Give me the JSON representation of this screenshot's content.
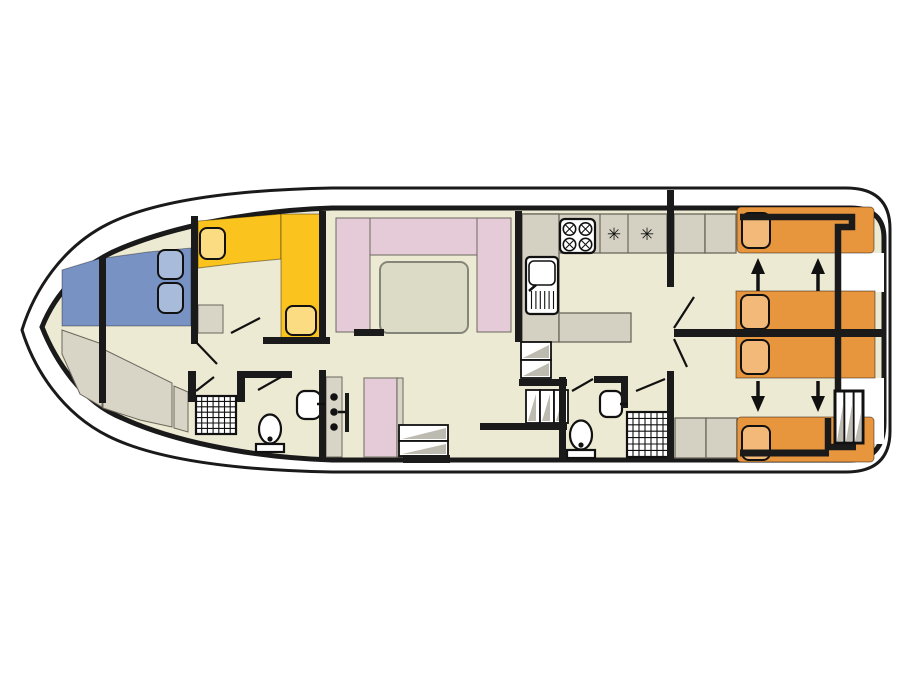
{
  "plan": {
    "type": "boat-floorplan",
    "orientation": "bow-left",
    "areas": [
      "bow-cabin",
      "forward-bathroom",
      "port-cabin",
      "saloon",
      "galley",
      "mid-cabin",
      "aft-stairs",
      "aft-bathroom",
      "aft-cabin-port",
      "aft-cabin-starboard",
      "stern-deck"
    ],
    "berths": {
      "bow_double": 1,
      "port_l_shaped_singles": 2,
      "mid_single": 1,
      "aft_fixed_singles": 2,
      "aft_sliding_doubles": 2
    },
    "fixtures": {
      "toilets": 2,
      "showers": 2,
      "washbasins": 2,
      "hob_burners": 4,
      "galley_sink": 1,
      "appliance_symbols": 2,
      "stern_ladder": 1,
      "step_flights": 3
    },
    "sliding_bed_arrows": {
      "up": 2,
      "down": 2
    }
  },
  "symbols": {
    "appliance_star": "✳"
  },
  "colors": {
    "hull": "#FFFFFF",
    "line": "#1A1A1A",
    "floor": "#EDEAD3",
    "bench": "#D8D5C6",
    "counter": "#D5D1C2",
    "edge": "#6B675C",
    "blue": "#7792C3",
    "blue_l": "#A9BBDA",
    "yellow": "#FBC31D",
    "yellow_l": "#FCDC82",
    "pink": "#E5CBD8",
    "table": "#DCDBC5",
    "table_edge": "#85857A",
    "orange": "#E8963E",
    "orange_l": "#F2B978",
    "shade": "#BDBAB0"
  }
}
